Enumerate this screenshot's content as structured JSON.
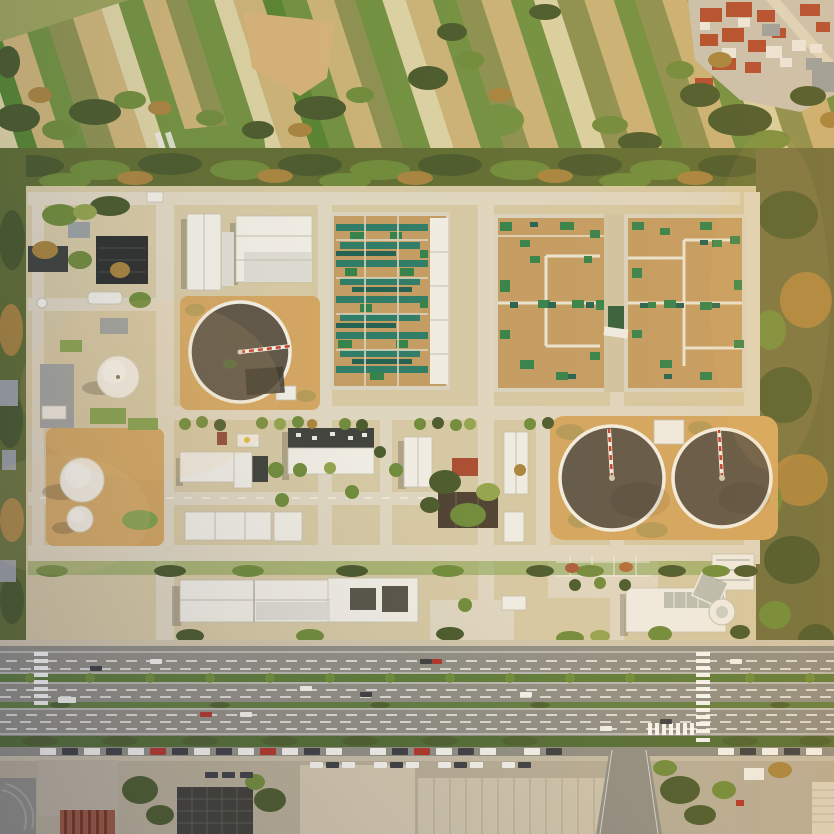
{
  "scene": {
    "description": "Aerial drone photograph of a wastewater treatment plant campus beside a multi-lane boulevard, with patchwork farmland and a red-roofed village to the north and city blocks to the south",
    "regions": {
      "farmland": "Patchwork crop fields with tree clusters",
      "village": "Red-tile-roofed houses, top right corner",
      "tree_belt": "Windbreak tree line between farmland and plant",
      "plant": "Treatment works: circular clarifiers, aeration basin, covered membrane basins, storage spheres, workshops",
      "boulevard": "Multi-lane road with planted medians and crosswalks",
      "city_blocks": "Roadside buildings, parking lots and plaza along bottom edge"
    },
    "features": {
      "circular_clarifiers": 3,
      "white_storage_spheres": 3,
      "covered_square_basins": 2,
      "aeration_basins": 1,
      "crosswalks": 3
    }
  },
  "palette": {
    "field_base": "#98a05a",
    "field_tan": "#c9b176",
    "field_olive": "#8a8f4f",
    "field_green": "#6f8f3f",
    "field_bright": "#55822f",
    "field_light": "#d9d0a2",
    "dirt": "#d3b077",
    "village_ground": "#c9c2b2",
    "roof_red": "#b14a2e",
    "roof_white": "#ece9e2",
    "roof_gray": "#9aa0a2",
    "belt_base": "#5d6b31",
    "tree_dark": "#47582b",
    "tree_mid": "#6d8a3a",
    "tree_light": "#90a34d",
    "tree_autumn": "#a5823d",
    "right_band": "#6d6d3d",
    "facility_ground": "#d4c8a4",
    "road": "#ded6c2",
    "white_bldg": "#efede6",
    "silver_bldg": "#dcdbd4",
    "bldg_shade": "#c2beb1",
    "dark_bldg": "#3c403b",
    "darker_bldg": "#2b2e2d",
    "brown_bldg": "#4a3e31",
    "water": "#5c5447",
    "rim": "#f4f1e8",
    "bridge_red": "#c23b2a",
    "basin_tan": "#c29b62",
    "teal": "#2a7a66",
    "teal_dark": "#1e5f50",
    "green_patch": "#2f8049",
    "lawn": "#7fa04a",
    "dirt_pad": "#d2a560",
    "main_road": "#8e8d84",
    "lane": "#ffffff",
    "median_green": "#5a7a38",
    "hedge": "#4f6b33",
    "car_white": "#f2f2ee",
    "car_dark": "#3a3d42",
    "car_red": "#b03228",
    "city_concrete": "#b5ac97",
    "plaza": "#cfc5ae",
    "roof_grid": "#3a3b36",
    "roof_big": "#ccc3ad",
    "red_stripe_roof": "#96543e",
    "glass": "#b9bdb4"
  }
}
